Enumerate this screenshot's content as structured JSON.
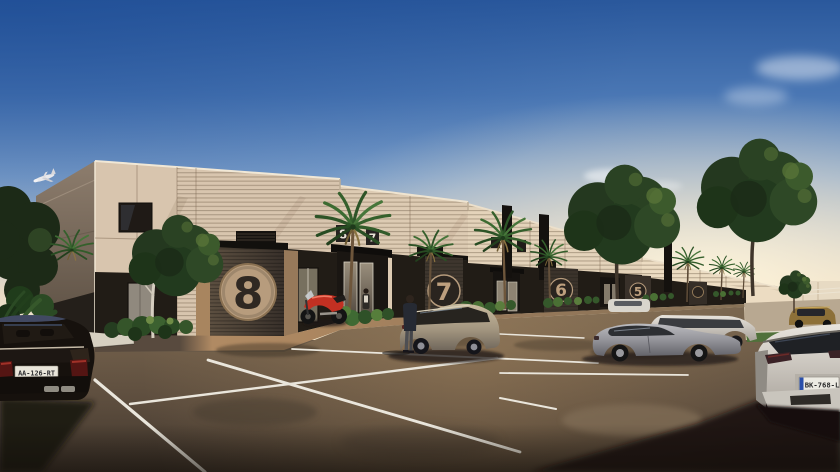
{
  "scene": {
    "description": "Sunset 3D architectural rendering: row of flex warehouse units with numbered roller doors, palm trees and parking lot",
    "sky": {
      "top": "#2a589c",
      "mid": "#7fa2cc",
      "horizon": "#f6ead1",
      "glow": "#fff6dd"
    },
    "building": {
      "wall_color": "#d8c5ae",
      "storefront_color": "#211c16",
      "door_face_color": "#4a4034",
      "emblem_tan": "#b79c7d",
      "units": [
        {
          "id": "unit-8",
          "door_number": "8"
        },
        {
          "id": "unit-7",
          "door_number": "7"
        },
        {
          "id": "unit-6",
          "door_number": "6"
        },
        {
          "id": "unit-5",
          "door_number": "5"
        }
      ],
      "wall_signs": [
        {
          "label": "8"
        },
        {
          "label": "7"
        }
      ]
    },
    "vehicles": {
      "dark_sedan": {
        "plate": "AA-126-RT",
        "color": "#17120e"
      },
      "white_hatchback": {
        "plate": "BK-768-L",
        "color": "#dcd8d1"
      },
      "motorcycle": {
        "color": "#c23022"
      },
      "station_wagon": {
        "color": "#b3a58f"
      },
      "gray_sedan": {
        "color": "#97979b"
      },
      "gold_suv": {
        "color": "#8d7038"
      }
    },
    "lot": {
      "asphalt": "#6a5a48",
      "line_color": "#eae6dc"
    },
    "vegetation": {
      "palm": "#3f6b35",
      "tree": "#263a20",
      "grass": "#50713a"
    },
    "airplane": {
      "color": "#e9e9ec"
    }
  }
}
